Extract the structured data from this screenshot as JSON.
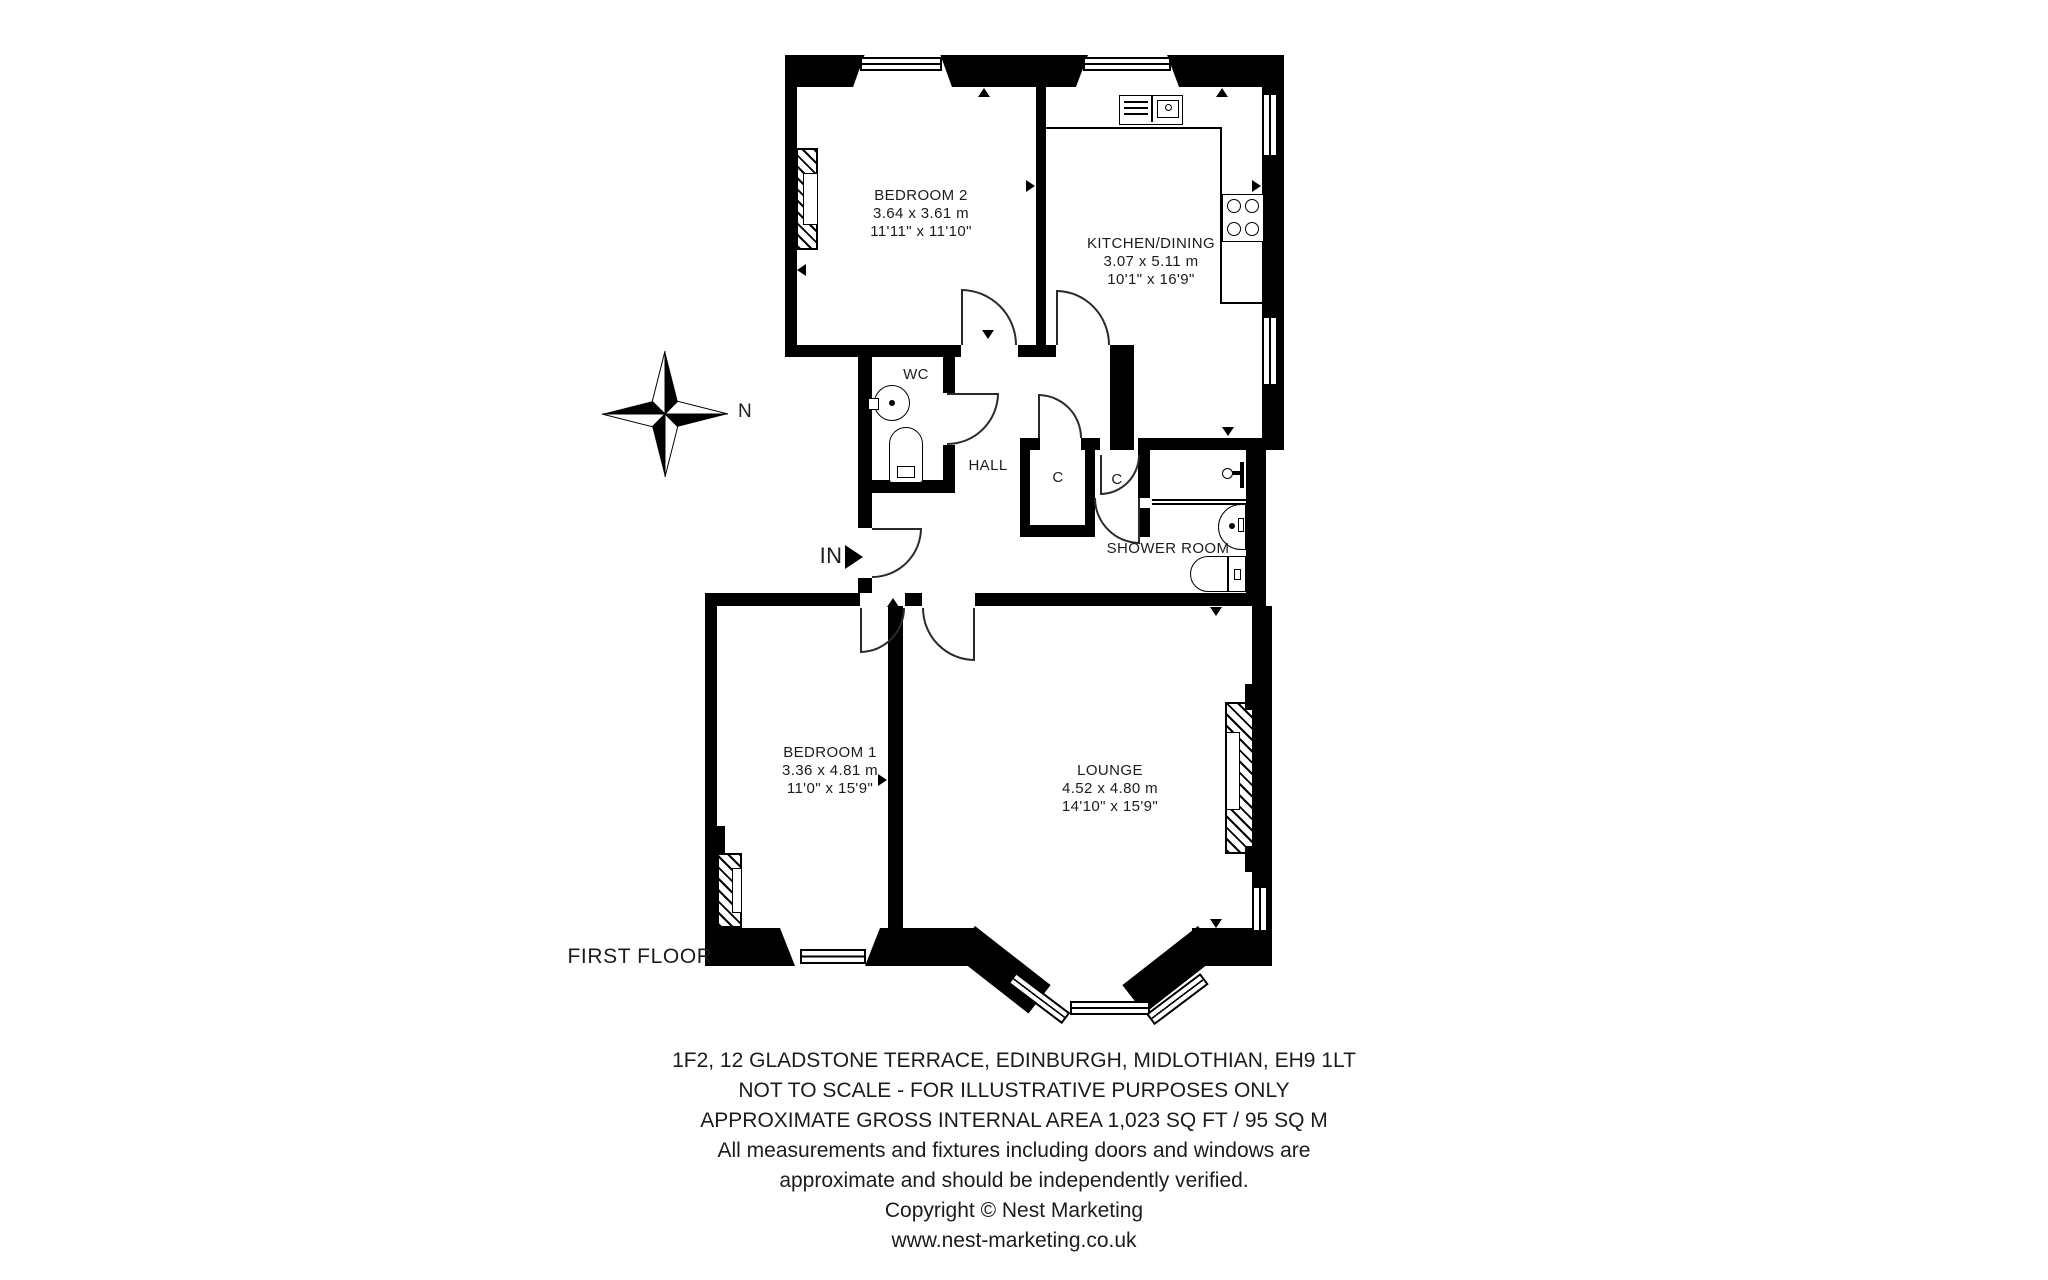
{
  "plan": {
    "floor_label": "FIRST FLOOR",
    "compass_label": "N",
    "entry_label": "IN",
    "rooms": {
      "bedroom2": {
        "name": "BEDROOM 2",
        "metric": "3.64 x 3.61 m",
        "imperial": "11'11\" x 11'10\""
      },
      "kitchen": {
        "name": "KITCHEN/DINING",
        "metric": "3.07 x 5.11 m",
        "imperial": "10'1\" x 16'9\""
      },
      "wc": {
        "name": "WC"
      },
      "hall": {
        "name": "HALL"
      },
      "closet1": {
        "name": "C"
      },
      "closet2": {
        "name": "C"
      },
      "shower": {
        "name": "SHOWER ROOM"
      },
      "bedroom1": {
        "name": "BEDROOM 1",
        "metric": "3.36 x 4.81 m",
        "imperial": "11'0\" x 15'9\""
      },
      "lounge": {
        "name": "LOUNGE",
        "metric": "4.52 x 4.80 m",
        "imperial": "14'10\" x 15'9\""
      }
    }
  },
  "footer": {
    "line1": "1F2, 12 GLADSTONE TERRACE, EDINBURGH, MIDLOTHIAN, EH9 1LT",
    "line2": "NOT TO SCALE - FOR ILLUSTRATIVE PURPOSES ONLY",
    "line3": "APPROXIMATE GROSS INTERNAL AREA 1,023 SQ FT / 95 SQ M",
    "line4": "All measurements and fixtures including doors and windows are",
    "line5": "approximate and should be independently verified.",
    "line6": "Copyright © Nest Marketing",
    "line7": "www.nest-marketing.co.uk"
  },
  "colors": {
    "wall": "#000000",
    "background": "#ffffff",
    "text": "#1c1c1c"
  }
}
